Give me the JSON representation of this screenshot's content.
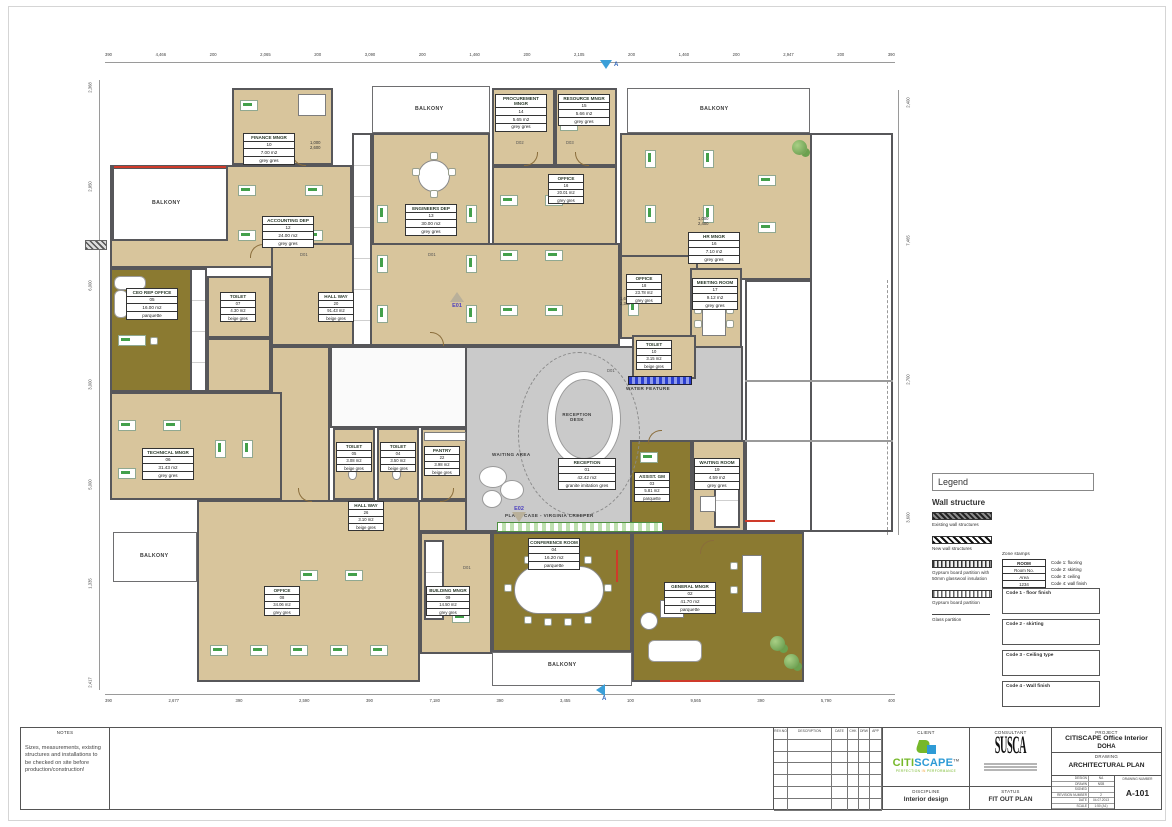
{
  "plan": {
    "balcony_label": "BALKONY",
    "labels": {
      "waiting_area": "WAITING AREA",
      "reception_desk": "RECEPTION DESK",
      "water_feature": "WATER FEATURE",
      "plant_case": "PLANT CASE - VIRGINIA CREEPER"
    },
    "markers": {
      "section": "A",
      "e01": "E01",
      "e02": "E02"
    },
    "door_tags": [
      "D01",
      "D01",
      "D02",
      "D03",
      "D01",
      "D01"
    ],
    "door_dims": [
      [
        "1,000",
        "2,600"
      ],
      [
        "1,000",
        "2,400"
      ],
      [
        "1,625",
        "2,350"
      ]
    ],
    "rooms": [
      {
        "name": "FINANCE MNGR",
        "no": "10",
        "area": "7.00 m2",
        "floor": "grey gres"
      },
      {
        "name": "ACCOUNTING DEP",
        "no": "12",
        "area": "24.00 m2",
        "floor": "grey gres"
      },
      {
        "name": "ENGINEERS DEP",
        "no": "13",
        "area": "30.00 m2",
        "floor": "grey gres"
      },
      {
        "name": "PROCUREMENT MNGR",
        "no": "14",
        "area": "5.65 m2",
        "floor": "grey gres"
      },
      {
        "name": "RESOURCE MNGR",
        "no": "15",
        "area": "5.66 m2",
        "floor": "grey gres"
      },
      {
        "name": "OFFICE",
        "no": "16",
        "area": "20.01 m2",
        "floor": "grey gres"
      },
      {
        "name": "HR MNGR",
        "no": "16",
        "area": "7.10 m2",
        "floor": "grey gres"
      },
      {
        "name": "OFFICE",
        "no": "18",
        "area": "23.78 m2",
        "floor": "grey gres"
      },
      {
        "name": "MEETING ROOM",
        "no": "17",
        "area": "9.12 m2",
        "floor": "grey gres"
      },
      {
        "name": "TOILET",
        "no": "10",
        "area": "3.15 m2",
        "floor": "beige gres"
      },
      {
        "name": "CEO REP OFFICE",
        "no": "05",
        "area": "16.00 m2",
        "floor": "parquette"
      },
      {
        "name": "TOILET",
        "no": "07",
        "area": "4.30 m2",
        "floor": "beige gres"
      },
      {
        "name": "HALL WAY",
        "no": "20",
        "area": "91.43 m2",
        "floor": "beige gres"
      },
      {
        "name": "TECHNICAL MNGR",
        "no": "06",
        "area": "31.43 m2",
        "floor": "grey gres"
      },
      {
        "name": "TOILET",
        "no": "05",
        "area": "3.08 m2",
        "floor": "beige gres"
      },
      {
        "name": "TOILET",
        "no": "04",
        "area": "3.50 m2",
        "floor": "beige gres"
      },
      {
        "name": "PANTRY",
        "no": "22",
        "area": "3.98 m2",
        "floor": "beige gres"
      },
      {
        "name": "HALL WAY",
        "no": "26",
        "area": "3.10 m2",
        "floor": "beige gres"
      },
      {
        "name": "RECEPTION",
        "no": "01",
        "area": "42.42 m2",
        "floor": "granite imitation gres"
      },
      {
        "name": "ASSIST. GM",
        "no": "03",
        "area": "5.81 m2",
        "floor": "parquette"
      },
      {
        "name": "WAITING ROOM",
        "no": "19",
        "area": "4.59 m2",
        "floor": "grey gres"
      },
      {
        "name": "CONFERENCE ROOM",
        "no": "04",
        "area": "16.20 m2",
        "floor": "parquette"
      },
      {
        "name": "GENERAL MNGR",
        "no": "02",
        "area": "41.70 m2",
        "floor": "parquette"
      },
      {
        "name": "BUILDING MNGR",
        "no": "09",
        "area": "14.50 m2",
        "floor": "grey gres"
      },
      {
        "name": "OFFICE",
        "no": "08",
        "area": "34.06 m2",
        "floor": "grey gres"
      }
    ]
  },
  "dims": {
    "top": [
      "390",
      "4,466",
      "200",
      "2,065",
      "200",
      "3,090",
      "200",
      "1,460",
      "200",
      "2,105",
      "200",
      "1,460",
      "200",
      "2,947",
      "200",
      "390"
    ],
    "bottom": [
      "390",
      "2,677",
      "390",
      "2,590",
      "390",
      "7,180",
      "390",
      "3,455",
      "100",
      "9,565",
      "390",
      "5,790",
      "400"
    ],
    "left": [
      "2,368",
      "2,950",
      "6,000",
      "3,000",
      "5,000",
      "1,335",
      "2,417"
    ],
    "right": [
      "2,400",
      "7,465",
      "2,700",
      "3,600"
    ]
  },
  "legend": {
    "title": "Legend",
    "wall_structure_title": "Wall structure",
    "wall_items": [
      "Existing wall structures",
      "New wall structures",
      "Gypsum board partition with 50mm glasswool insulation",
      "Gypsum board partition",
      "Glass partition"
    ],
    "zone_stamps_title": "Zone stamps",
    "sample_stamp": {
      "name": "ROOM",
      "row2": "Room No.",
      "row3": "Area",
      "row4": "1234"
    },
    "codes": [
      "Code 1: flooring",
      "Code 2: skirting",
      "Code 3: ceiling",
      "Code 4: wall finish"
    ],
    "code_boxes": [
      "Code 1 - floor finish",
      "Code 2 - skirting",
      "Code 3 - Ceiling type",
      "Code 4 - Wall finish"
    ]
  },
  "notes": {
    "title": "NOTES",
    "text": "Sizes, measurements, existing structures and installations to be checked on site before production/construction!"
  },
  "revisions": {
    "headers": [
      "REV.NO",
      "DESCRIPTION",
      "DATE",
      "CHK",
      "DRW",
      "APP"
    ]
  },
  "titleblock": {
    "client_label": "CLIENT",
    "consultant_label": "CONSULTANT",
    "project_label": "PROJECT",
    "project_name": "CITISCAPE Office Interior",
    "project_city": "DOHA",
    "drawing_label": "DRAWING",
    "drawing_name": "ARCHITECTURAL PLAN",
    "discipline_label": "DISCIPLINE",
    "discipline": "Interior design",
    "status_label": "STATUS",
    "status": "FIT OUT PLAN",
    "logo_citi": "CITI",
    "logo_scape": "SCAPE",
    "logo_tm": "TM",
    "logo_tagline_1": "PERFECTION",
    "logo_tagline_2": "IN",
    "logo_tagline_3": "PERFORMANCE",
    "consultant_logo": "SUSCA",
    "info_rows": [
      [
        "DESIGN",
        "NA"
      ],
      [
        "DRAWN",
        "NSB"
      ],
      [
        "SIGNED",
        ""
      ],
      [
        "REVISION NUMBER",
        "2"
      ],
      [
        "DATE",
        "04.07.2013"
      ],
      [
        "SCALE",
        "1:50 (A1)"
      ]
    ],
    "drawing_number_label": "DRAWING NUMBER",
    "drawing_number": "A-101"
  }
}
